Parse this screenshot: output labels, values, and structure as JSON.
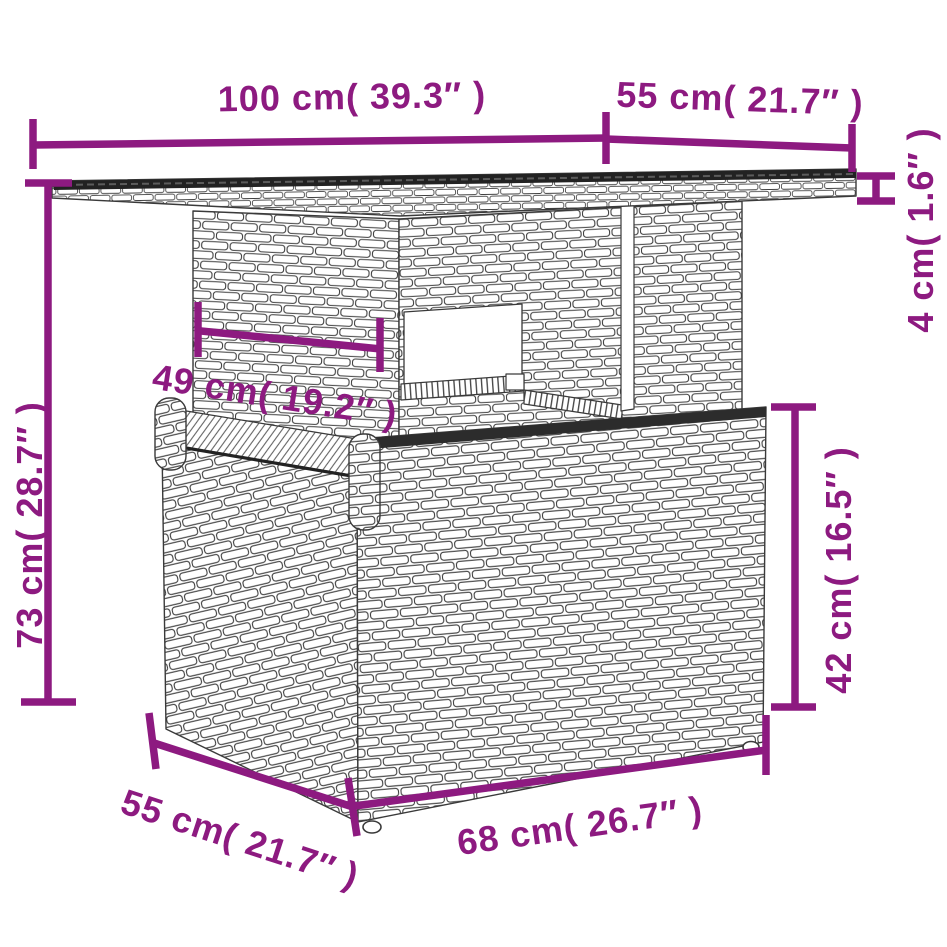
{
  "illustration": {
    "subject": "poly-rattan-table-line-drawing",
    "parts": [
      "tabletop",
      "support-column",
      "storage-base"
    ]
  },
  "colors": {
    "dimension_annotations": "#8D1A80",
    "line_art": "#3a3a3a",
    "tabletop_surface": "#222222",
    "background": "#ffffff"
  },
  "dimensions": [
    {
      "id": "tabletop-width",
      "label": "100 cm( 39.3″ )"
    },
    {
      "id": "tabletop-depth",
      "label": "55 cm( 21.7″ )"
    },
    {
      "id": "tabletop-thickness",
      "label": "4 cm( 1.6″ )"
    },
    {
      "id": "overall-height",
      "label": "73 cm( 28.7″ )"
    },
    {
      "id": "column-width",
      "label": "49 cm( 19.2″ )"
    },
    {
      "id": "base-height",
      "label": "42 cm( 16.5″ )"
    },
    {
      "id": "base-depth",
      "label": "55 cm( 21.7″ )"
    },
    {
      "id": "base-width",
      "label": "68 cm( 26.7″ )"
    }
  ]
}
